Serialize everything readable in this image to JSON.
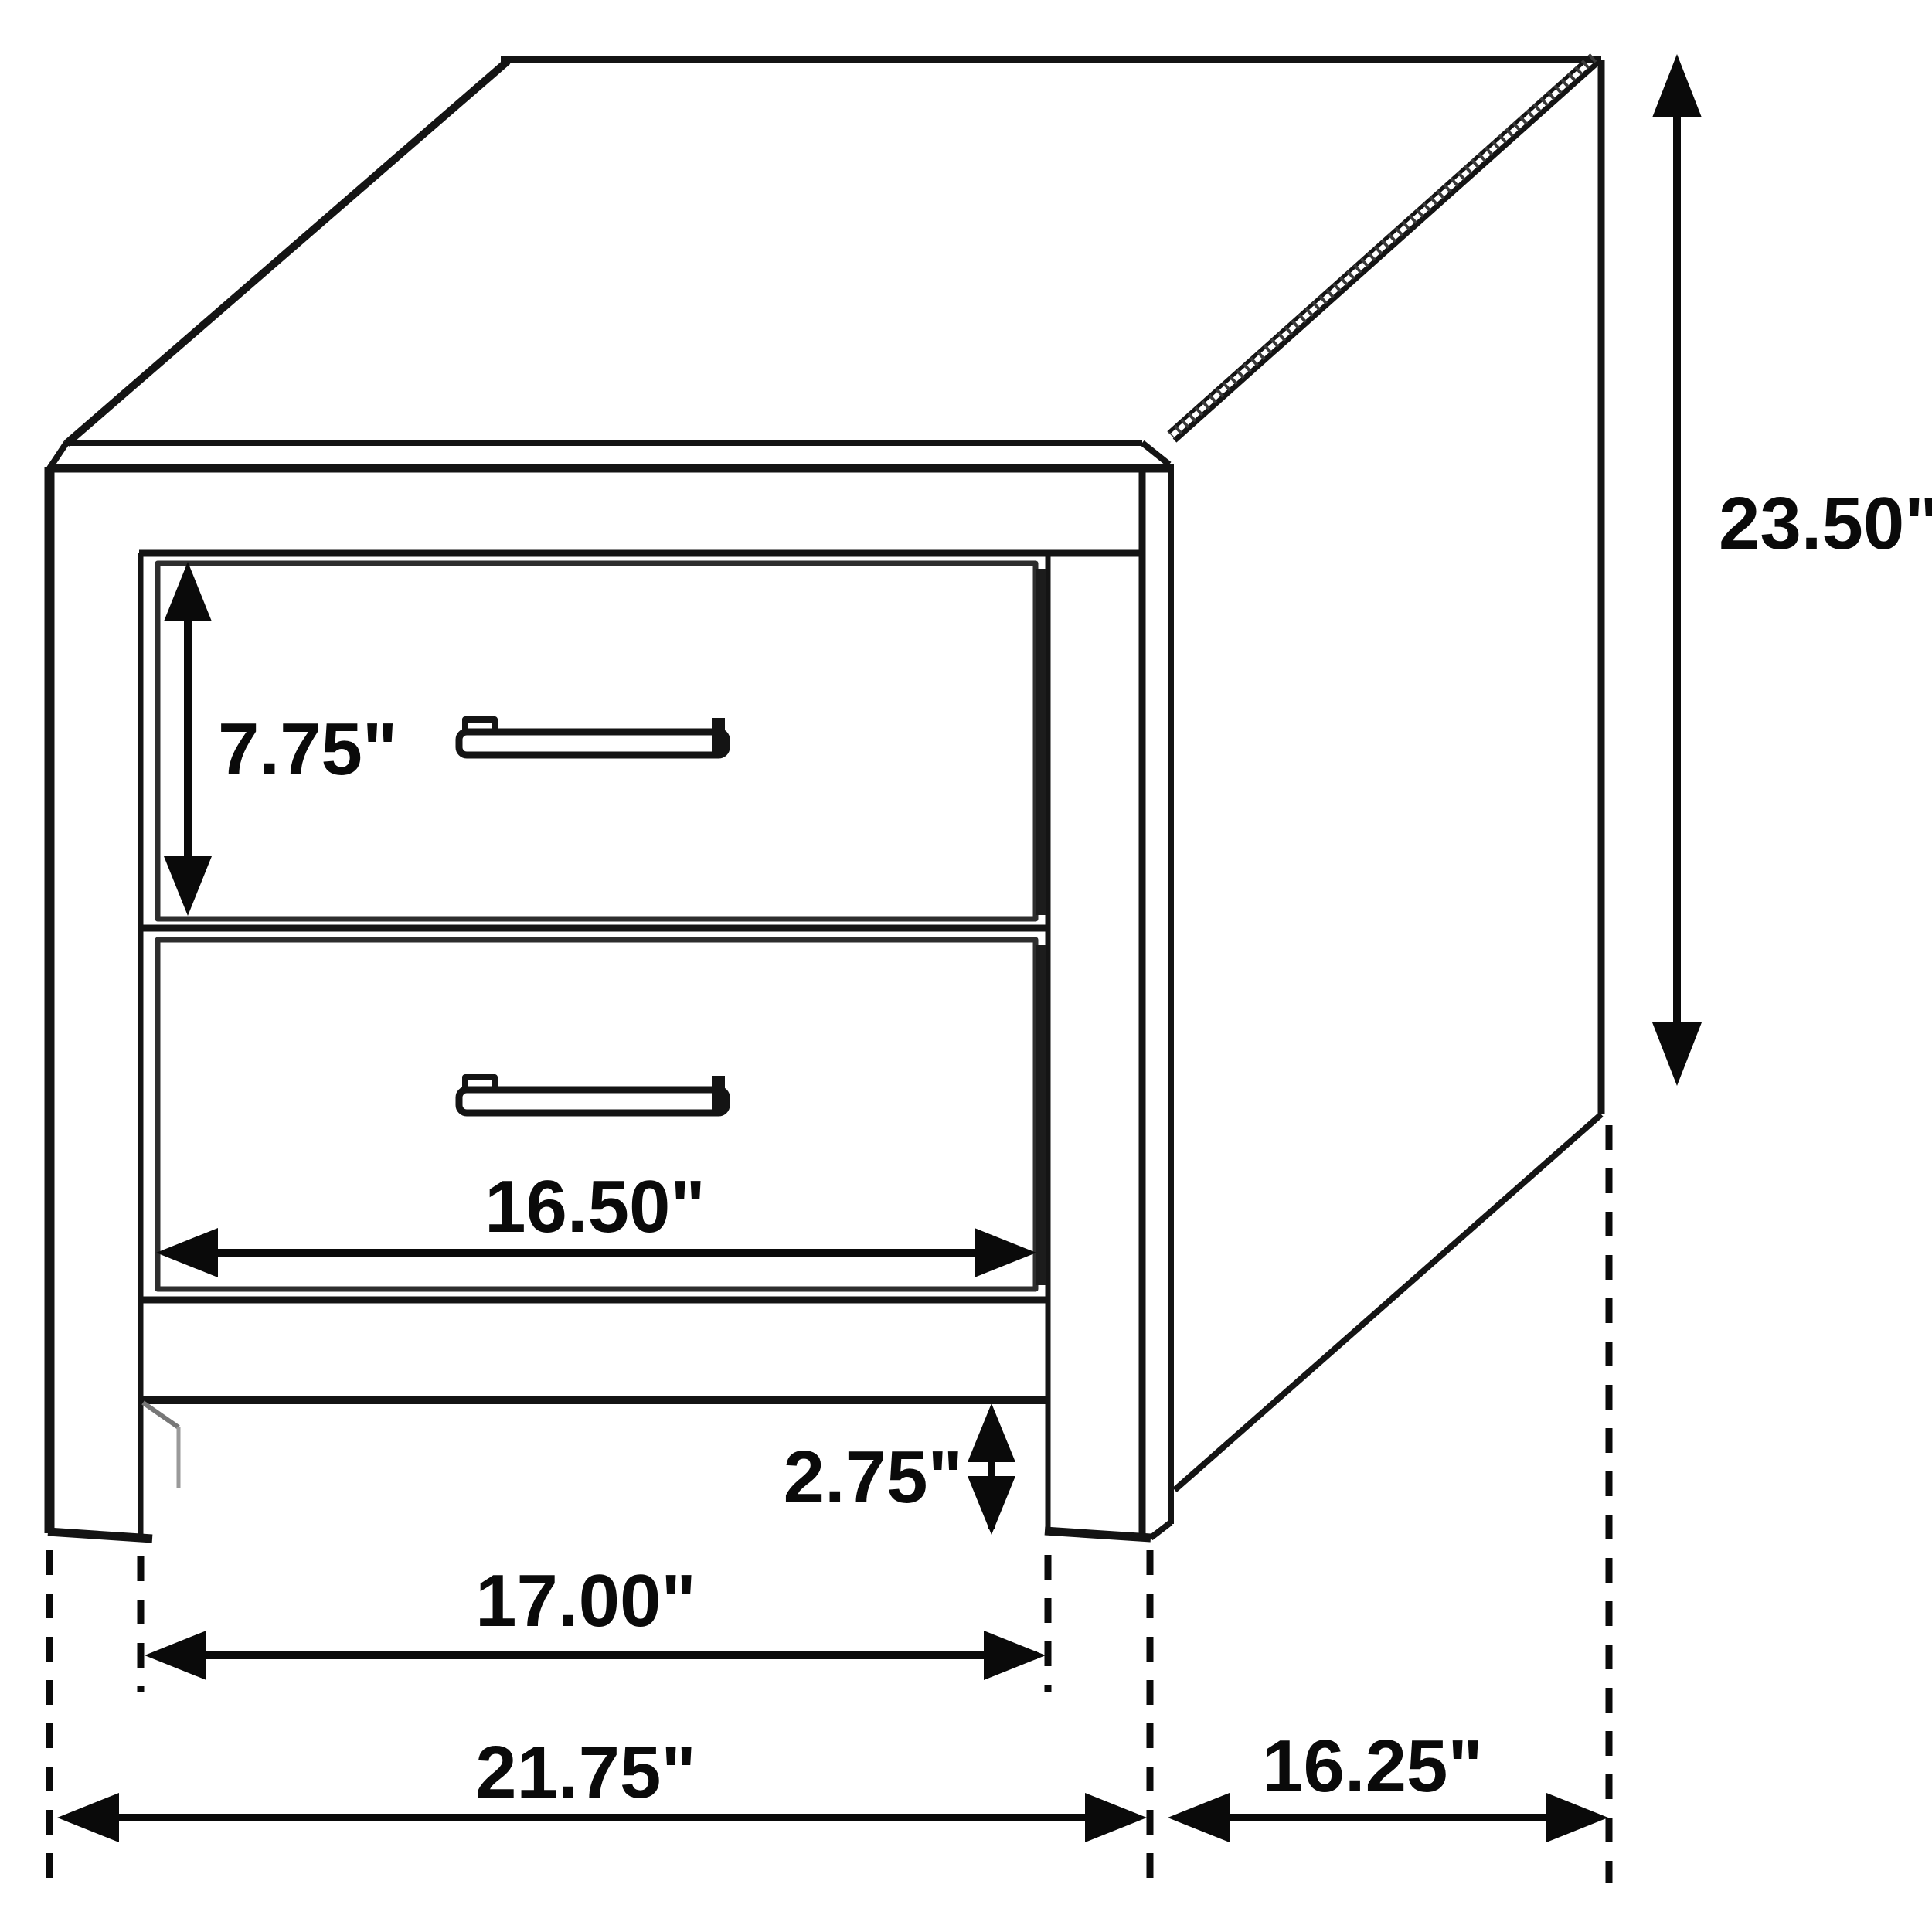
{
  "drawing": {
    "background": "#ffffff",
    "line_color": "#141414",
    "dimension_color": "#0a0a0a",
    "soft_line_color": "#8a8a8a",
    "labels": {
      "drawer_front_height": "7.75\"",
      "overall_height": "23.50\"",
      "drawer_front_width": "16.50\"",
      "base_clearance_height": "2.75\"",
      "inner_leg_span_width": "17.00\"",
      "overall_width": "21.75\"",
      "side_depth": "16.25\""
    }
  }
}
